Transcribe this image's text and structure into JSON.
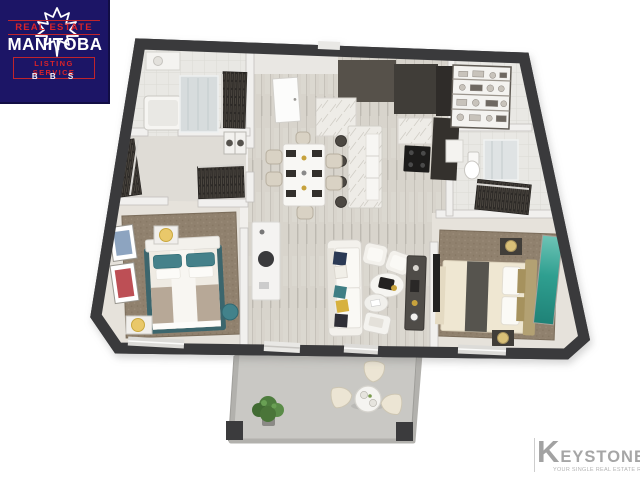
{
  "window": {
    "width": 640,
    "height": 480,
    "background": "#ffffff"
  },
  "logos": {
    "mls": {
      "top": "REAL ESTATE",
      "name": "MANITOBA",
      "bottom": "LISTING SERVICE",
      "sub": "B B S",
      "background": "#1c1566",
      "accent_red": "#d8232a",
      "leaf_icon": "maple-leaf-icon"
    },
    "keystone": {
      "initial": "K",
      "rest": "EYSTONE",
      "tagline": "YOUR SINGLE REAL ESTATE RESOURCE",
      "color": "#a6a6a6"
    }
  },
  "floorplan": {
    "type": "3d-rendered-floor-plan",
    "unit": "two-bedroom apartment with balcony",
    "rooms": [
      "primary bedroom",
      "second bedroom",
      "living room",
      "dining area",
      "kitchen with island",
      "bathroom",
      "ensuite bathroom",
      "walk-in closets",
      "laundry",
      "pantry shelving",
      "balcony"
    ],
    "palette": {
      "outer_walls": "#3a3a3c",
      "wood_floor": "#d8d4cc",
      "carpet": "#90816e",
      "accent_teal": "#3f7e84",
      "marble": "#eeece7",
      "balcony_floor": "#c9c8c4"
    }
  }
}
